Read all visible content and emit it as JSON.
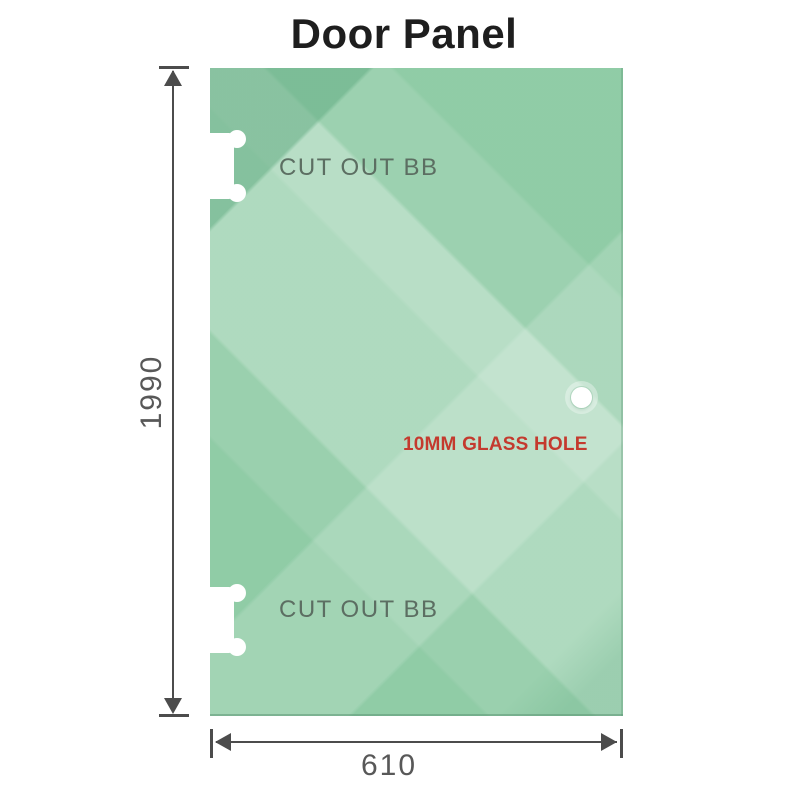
{
  "title": "Door Panel",
  "panel": {
    "glass_color": "#8ccaa3",
    "cutouts": [
      {
        "label": "CUT OUT BB"
      },
      {
        "label": "CUT OUT BB"
      }
    ],
    "hole": {
      "label": "10MM GLASS HOLE",
      "label_color": "#c43a2e"
    }
  },
  "dimensions": {
    "height_value": "1990",
    "width_value": "610",
    "line_color": "#4c4c4c",
    "text_color": "#585858"
  }
}
